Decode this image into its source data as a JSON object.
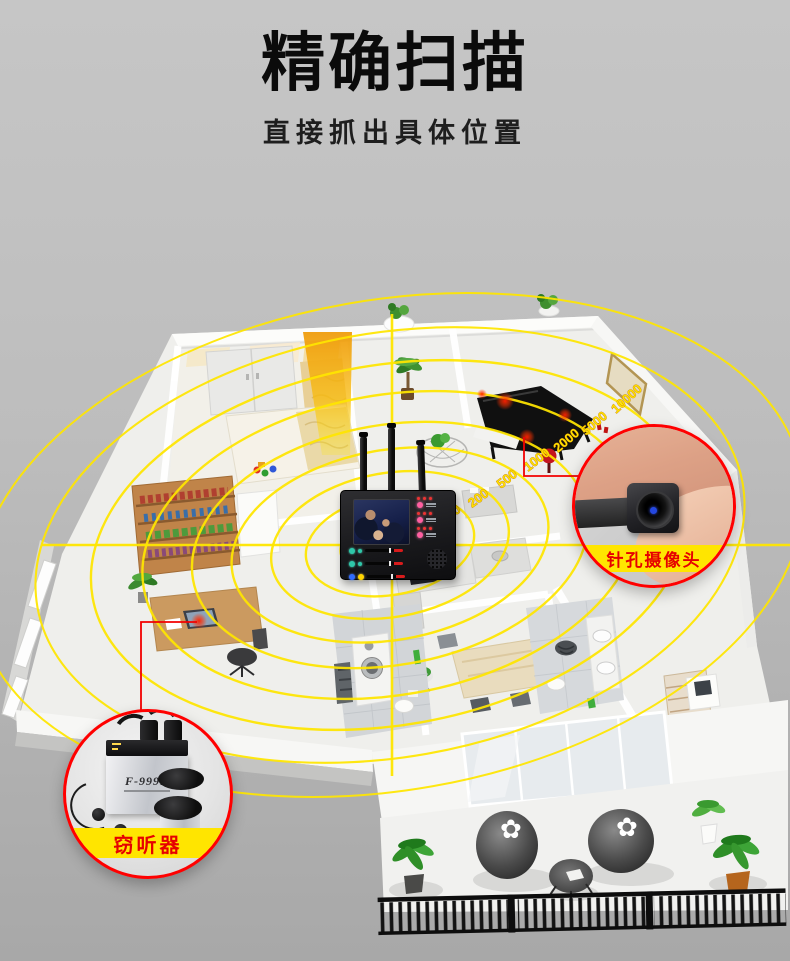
{
  "header": {
    "title": "精确扫描",
    "subtitle": "直接抓出具体位置"
  },
  "radar": {
    "color": "#ffe600",
    "ring_labels": [
      "100",
      "200",
      "500",
      "1000",
      "2000",
      "5000",
      "10000"
    ]
  },
  "callouts": {
    "camera": {
      "label": "针孔摄像头"
    },
    "wiretap": {
      "label": "窃听器",
      "model": "F-999B"
    }
  },
  "icons": {
    "beanbag_flower": "✿"
  },
  "colors": {
    "radar_yellow": "#ffe600",
    "beam_orange": "#f5a60a",
    "callout_border": "#ff0000",
    "label_bg": "#ffe500",
    "label_text": "#e60000",
    "detection_red": "#ff2000",
    "background_top": "#c6c6c6",
    "background_bottom": "#a8a8a8"
  }
}
